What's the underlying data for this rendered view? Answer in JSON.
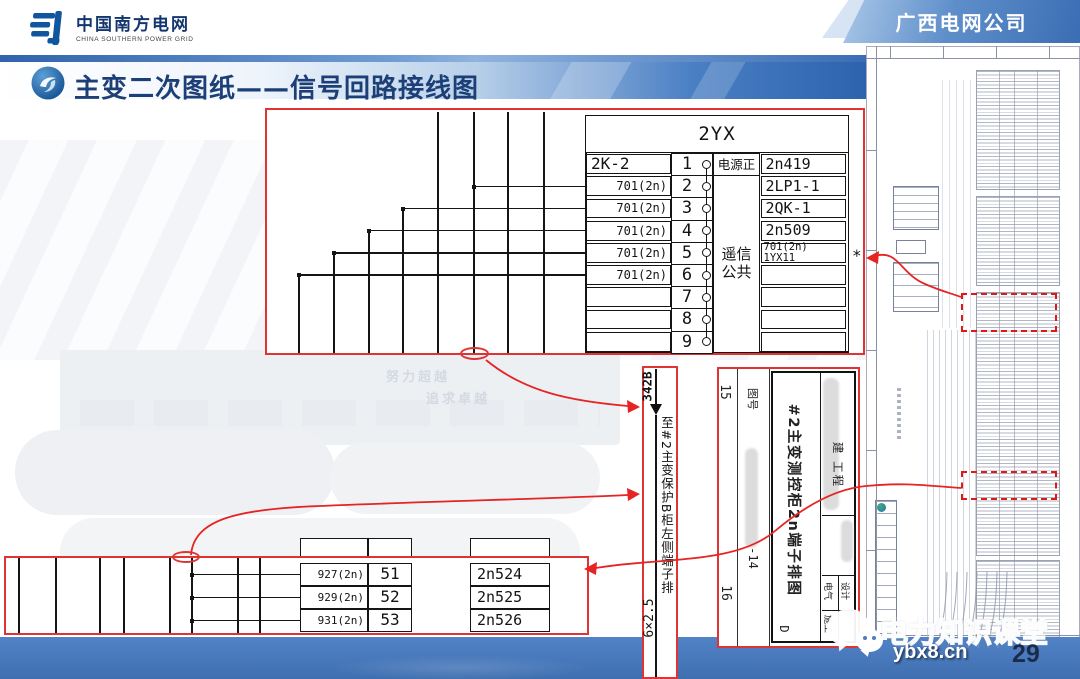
{
  "header": {
    "logo_cn": "中国南方电网",
    "logo_en": "CHINA SOUTHERN POWER GRID",
    "corp": "广西电网公司"
  },
  "slide": {
    "title": "主变二次图纸——信号回路接线图",
    "page": "29"
  },
  "bg_watermark": {
    "line1": "努力超越",
    "line2": "追求卓越"
  },
  "terminal_table": {
    "name": "2YX",
    "power_label": "电源正",
    "common_label_1": "遥信",
    "common_label_2": "公共",
    "star": "*",
    "rows": [
      {
        "left": "2K-2",
        "no": "1",
        "right": "2n419"
      },
      {
        "left": "701(2n)",
        "no": "2",
        "right": "2LP1-1"
      },
      {
        "left": "701(2n)",
        "no": "3",
        "right": "2QK-1"
      },
      {
        "left": "701(2n)",
        "no": "4",
        "right": "2n509"
      },
      {
        "left": "701(2n)",
        "no": "5",
        "right": "701(2n) 1YX11"
      },
      {
        "left": "701(2n)",
        "no": "6",
        "right": ""
      },
      {
        "left": "",
        "no": "7",
        "right": ""
      },
      {
        "left": "",
        "no": "8",
        "right": ""
      },
      {
        "left": "",
        "no": "9",
        "right": ""
      }
    ]
  },
  "cable": {
    "tag": "342B",
    "dest": "至#2主变保护B柜左侧端子排",
    "spec": "6×2.5"
  },
  "bottom_table": {
    "rows": [
      {
        "left": "927(2n)",
        "no": "51",
        "right": "2n524"
      },
      {
        "left": "929(2n)",
        "no": "52",
        "right": "2n525"
      },
      {
        "left": "931(2n)",
        "no": "53",
        "right": "2n526"
      }
    ]
  },
  "title_block": {
    "no_label": "图号",
    "left_top": "15",
    "left_bottom": "16",
    "code": "-14",
    "drawing_title": "#2主变测控柜2n端子排图",
    "stamp": "建 工程",
    "cell_a": "电气",
    "cell_b": "施工",
    "cell_c": "设计",
    "cell_d": "D"
  },
  "footer": {
    "brand": "电力知识课堂",
    "url": "ybx8.cn"
  }
}
